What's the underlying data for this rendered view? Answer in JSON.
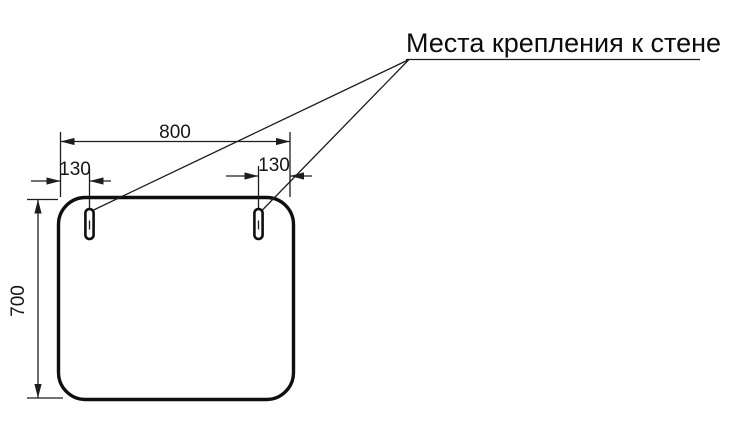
{
  "title": "Места крепления к стене",
  "dimensions": {
    "overall_width": "800",
    "overall_height": "700",
    "left_mount_offset": "130",
    "right_mount_offset": "130"
  },
  "colors": {
    "line": "#1d1d1d",
    "panel_outline": "#0f0f0f",
    "background": "#ffffff"
  }
}
